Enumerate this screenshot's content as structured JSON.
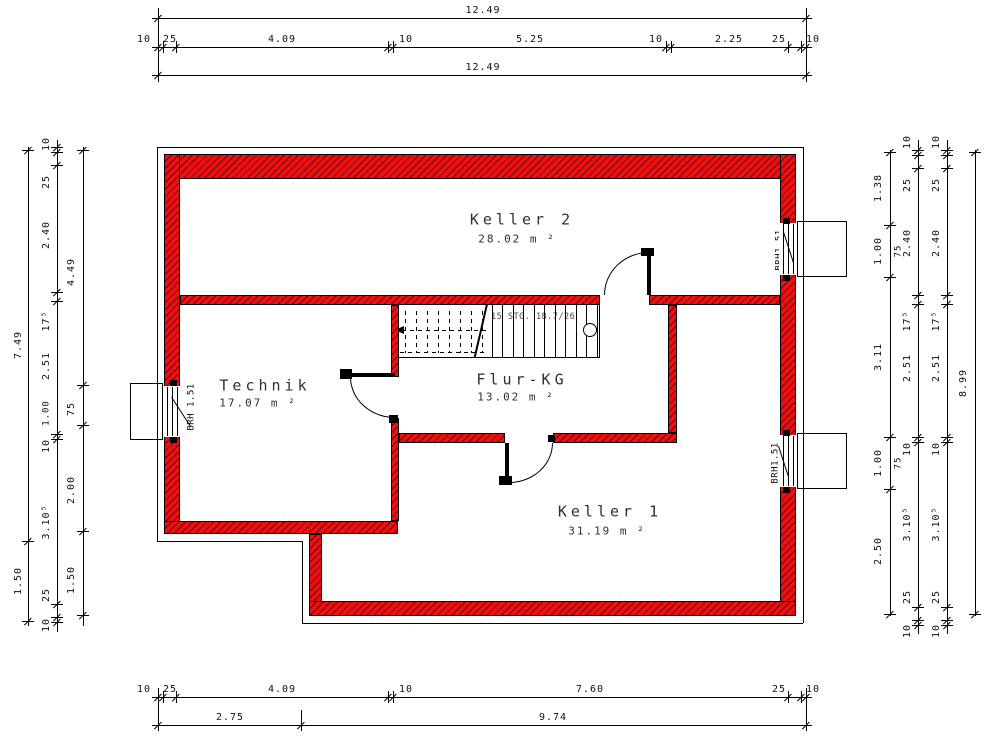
{
  "colors": {
    "wall": "#ee1010",
    "wall_hatch": "#3c0000",
    "line": "#000000",
    "dim_text": "#111111"
  },
  "rooms": [
    {
      "name": "Keller 2",
      "area": "28.02 m ²"
    },
    {
      "name": "Technik",
      "area": "17.07 m ²"
    },
    {
      "name": "Flur-KG",
      "area": "13.02 m ²"
    },
    {
      "name": "Keller 1",
      "area": "31.19 m ²"
    }
  ],
  "stair": {
    "note": "15 STG. 18.7/26"
  },
  "windows": [
    {
      "id": "left",
      "brh": "BRH 1.51",
      "tags": [
        "LS",
        "DK"
      ]
    },
    {
      "id": "right-top",
      "brh": "BRH1.51",
      "tags": [
        "DK",
        "LS"
      ]
    },
    {
      "id": "right-bottom",
      "brh": "BRH1.51",
      "tags": [
        "DK",
        "LS"
      ]
    }
  ],
  "dims": {
    "h": [
      {
        "y": 18,
        "x1": 152,
        "x2": 812,
        "ticks": [
          158,
          806
        ],
        "labels": [
          [
            "12.49",
            483
          ]
        ]
      },
      {
        "y": 47,
        "x1": 152,
        "x2": 812,
        "ticks": [
          158,
          163,
          176,
          388,
          393,
          666,
          671,
          788,
          801,
          806
        ],
        "labels": [
          [
            "10",
            144
          ],
          [
            "25",
            170
          ],
          [
            "4.09",
            282
          ],
          [
            "10",
            406
          ],
          [
            "5.25",
            530
          ],
          [
            "10",
            656
          ],
          [
            "2.25",
            729
          ],
          [
            "25",
            779
          ],
          [
            "10",
            813
          ]
        ]
      },
      {
        "y": 75,
        "x1": 152,
        "x2": 812,
        "ticks": [
          158,
          806
        ],
        "labels": [
          [
            "12.49",
            483
          ]
        ]
      },
      {
        "y": 697,
        "x1": 152,
        "x2": 812,
        "ticks": [
          158,
          163,
          176,
          388,
          393,
          788,
          801,
          806
        ],
        "labels": [
          [
            "10",
            144
          ],
          [
            "25",
            170
          ],
          [
            "4.09",
            282
          ],
          [
            "10",
            406
          ],
          [
            "7.60",
            590
          ],
          [
            "25",
            779
          ],
          [
            "10",
            813
          ]
        ]
      },
      {
        "y": 725,
        "x1": 152,
        "x2": 812,
        "ticks": [
          158,
          301,
          806
        ],
        "labels": [
          [
            "2.75",
            230
          ],
          [
            "9.74",
            553
          ]
        ]
      }
    ],
    "v": [
      {
        "x": 28,
        "lx": 19,
        "y1": 147,
        "y2": 626,
        "ticks": [
          150,
          541,
          621
        ],
        "labels": [
          [
            "7.49",
            345
          ],
          [
            "1.50",
            581
          ]
        ]
      },
      {
        "x": 57,
        "lx": 47,
        "y1": 140,
        "y2": 632,
        "ticks": [
          147,
          152,
          165,
          292,
          301,
          434,
          439,
          604,
          617,
          622
        ],
        "labels": [
          [
            "10",
            144
          ],
          [
            "25",
            182
          ],
          [
            "2.40",
            235
          ],
          [
            "17⁵",
            321
          ],
          [
            "2.51",
            366
          ],
          [
            "10",
            446
          ],
          [
            "3.10⁵",
            522
          ],
          [
            "25",
            595
          ],
          [
            "10",
            625
          ]
        ]
      },
      {
        "x": 83,
        "lx": 72,
        "y1": 147,
        "y2": 626,
        "ticks": [
          150,
          385,
          425,
          531,
          615
        ],
        "labels": [
          [
            "4.49",
            272
          ],
          [
            "75",
            409
          ],
          [
            "2.00",
            490
          ],
          [
            "1.50",
            580
          ]
        ]
      },
      {
        "x": 890,
        "lx": 879,
        "y1": 150,
        "y2": 616,
        "ticks": [
          152,
          225,
          277,
          437,
          489,
          614
        ],
        "labels": [
          [
            "1.38",
            188
          ],
          [
            "1.00",
            251
          ],
          [
            "3.11",
            357
          ],
          [
            "1.00",
            463
          ],
          [
            "2.50",
            551
          ]
        ]
      },
      {
        "x": 918,
        "lx": 908,
        "y1": 140,
        "y2": 634,
        "ticks": [
          150,
          155,
          168,
          295,
          304,
          437,
          442,
          607,
          620,
          625
        ],
        "labels": [
          [
            "10",
            142
          ],
          [
            "25",
            185
          ],
          [
            "2.40",
            243
          ],
          [
            "17⁵",
            321
          ],
          [
            "2.51",
            368
          ],
          [
            "10",
            449
          ],
          [
            "3.10⁵",
            524
          ],
          [
            "25",
            597
          ],
          [
            "10",
            631
          ]
        ]
      },
      {
        "x": 947,
        "lx": 937,
        "y1": 140,
        "y2": 634,
        "ticks": [
          150,
          155,
          168,
          295,
          304,
          437,
          442,
          607,
          620,
          625
        ],
        "labels": [
          [
            "10",
            142
          ],
          [
            "25",
            185
          ],
          [
            "2.40",
            243
          ],
          [
            "17⁵",
            321
          ],
          [
            "2.51",
            368
          ],
          [
            "10",
            449
          ],
          [
            "3.10⁵",
            524
          ],
          [
            "25",
            597
          ],
          [
            "10",
            631
          ]
        ]
      },
      {
        "x": 975,
        "lx": 964,
        "y1": 150,
        "y2": 616,
        "ticks": [
          152,
          614
        ],
        "labels": [
          [
            "8.99",
            383
          ]
        ]
      }
    ],
    "extras": [
      [
        "1.00",
        47,
        413
      ],
      [
        "75",
        899,
        251
      ],
      [
        "75",
        899,
        463
      ]
    ]
  },
  "geometry": {
    "walls": [
      {
        "x": 164,
        "y": 154,
        "w": 632,
        "h": 25
      },
      {
        "x": 164,
        "y": 154,
        "w": 16,
        "h": 380
      },
      {
        "x": 780,
        "y": 154,
        "w": 16,
        "h": 462
      },
      {
        "x": 164,
        "y": 521,
        "w": 234,
        "h": 13
      },
      {
        "x": 309,
        "y": 534,
        "w": 13,
        "h": 82
      },
      {
        "x": 309,
        "y": 601,
        "w": 487,
        "h": 15
      },
      {
        "x": 180,
        "y": 295,
        "w": 420,
        "h": 10
      },
      {
        "x": 649,
        "y": 295,
        "w": 131,
        "h": 10
      },
      {
        "x": 391,
        "y": 305,
        "w": 8,
        "h": 72
      },
      {
        "x": 391,
        "y": 418,
        "w": 8,
        "h": 103
      },
      {
        "x": 399,
        "y": 433,
        "w": 106,
        "h": 10
      },
      {
        "x": 553,
        "y": 433,
        "w": 124,
        "h": 10
      },
      {
        "x": 668,
        "y": 305,
        "w": 9,
        "h": 128
      }
    ],
    "white_rects": [
      {
        "x": 163,
        "y": 386,
        "w": 18,
        "h": 51
      },
      {
        "x": 779,
        "y": 223,
        "w": 18,
        "h": 52
      },
      {
        "x": 779,
        "y": 435,
        "w": 18,
        "h": 52
      },
      {
        "x": 130,
        "y": 383,
        "w": 33,
        "h": 57,
        "b": 1
      },
      {
        "x": 797,
        "y": 221,
        "w": 50,
        "h": 56,
        "b": 1
      },
      {
        "x": 797,
        "y": 433,
        "w": 50,
        "h": 56,
        "b": 1
      }
    ],
    "lines": [
      {
        "x": 157,
        "y": 147,
        "w": 646,
        "h": 1
      },
      {
        "x": 157,
        "y": 147,
        "w": 1,
        "h": 394
      },
      {
        "x": 803,
        "y": 147,
        "w": 1,
        "h": 476
      },
      {
        "x": 157,
        "y": 541,
        "w": 145,
        "h": 1
      },
      {
        "x": 302,
        "y": 541,
        "w": 1,
        "h": 82
      },
      {
        "x": 302,
        "y": 623,
        "w": 501,
        "h": 1
      },
      {
        "x": 167,
        "y": 387,
        "w": 1,
        "h": 49
      },
      {
        "x": 172,
        "y": 387,
        "w": 1,
        "h": 49
      },
      {
        "x": 177,
        "y": 387,
        "w": 1,
        "h": 49
      },
      {
        "x": 783,
        "y": 224,
        "w": 1,
        "h": 50
      },
      {
        "x": 788,
        "y": 224,
        "w": 1,
        "h": 50
      },
      {
        "x": 793,
        "y": 224,
        "w": 1,
        "h": 50
      },
      {
        "x": 783,
        "y": 436,
        "w": 1,
        "h": 50
      },
      {
        "x": 788,
        "y": 436,
        "w": 1,
        "h": 50
      },
      {
        "x": 793,
        "y": 436,
        "w": 1,
        "h": 50
      },
      {
        "x": 492,
        "y": 305,
        "w": 1,
        "h": 52
      },
      {
        "x": 502,
        "y": 305,
        "w": 1,
        "h": 52
      },
      {
        "x": 513,
        "y": 305,
        "w": 1,
        "h": 52
      },
      {
        "x": 523,
        "y": 305,
        "w": 1,
        "h": 52
      },
      {
        "x": 534,
        "y": 305,
        "w": 1,
        "h": 52
      },
      {
        "x": 544,
        "y": 305,
        "w": 1,
        "h": 52
      },
      {
        "x": 555,
        "y": 305,
        "w": 1,
        "h": 52
      },
      {
        "x": 565,
        "y": 305,
        "w": 1,
        "h": 52
      },
      {
        "x": 576,
        "y": 305,
        "w": 1,
        "h": 52
      },
      {
        "x": 586,
        "y": 305,
        "w": 1,
        "h": 52
      },
      {
        "x": 597,
        "y": 305,
        "w": 1,
        "h": 52
      },
      {
        "x": 599,
        "y": 305,
        "w": 1,
        "h": 52
      },
      {
        "x": 399,
        "y": 357,
        "w": 201,
        "h": 1
      },
      {
        "x": 405,
        "y": 311,
        "w": 1,
        "h": 42,
        "d": 1
      },
      {
        "x": 416,
        "y": 311,
        "w": 1,
        "h": 42,
        "d": 1
      },
      {
        "x": 427,
        "y": 311,
        "w": 1,
        "h": 42,
        "d": 1
      },
      {
        "x": 438,
        "y": 311,
        "w": 1,
        "h": 42,
        "d": 1
      },
      {
        "x": 449,
        "y": 311,
        "w": 1,
        "h": 42,
        "d": 1
      },
      {
        "x": 460,
        "y": 311,
        "w": 1,
        "h": 42,
        "d": 1
      },
      {
        "x": 471,
        "y": 311,
        "w": 1,
        "h": 42,
        "d": 1
      },
      {
        "x": 482,
        "y": 311,
        "w": 1,
        "h": 42,
        "d": 1
      },
      {
        "x": 400,
        "y": 352,
        "w": 86,
        "h": 1,
        "d": 1
      },
      {
        "x": 402,
        "y": 330,
        "w": 84,
        "h": 1,
        "d": 1
      },
      {
        "x": 158,
        "y": 8,
        "w": 1,
        "h": 74
      },
      {
        "x": 806,
        "y": 8,
        "w": 1,
        "h": 74
      },
      {
        "x": 158,
        "y": 688,
        "w": 1,
        "h": 43
      },
      {
        "x": 806,
        "y": 688,
        "w": 1,
        "h": 43
      },
      {
        "x": 301,
        "y": 710,
        "w": 1,
        "h": 21
      }
    ],
    "rot_lines": [
      {
        "x": 486,
        "y": 304,
        "w": 2,
        "h": 55,
        "a": 13
      },
      {
        "x": 172,
        "y": 397,
        "w": 35,
        "h": 1,
        "a": 57
      },
      {
        "x": 784,
        "y": 232,
        "w": 33,
        "h": 1,
        "a": 72
      },
      {
        "x": 779,
        "y": 446,
        "w": 33,
        "h": 1,
        "a": 72
      }
    ],
    "blocks": [
      {
        "x": 647,
        "y": 252,
        "w": 4,
        "h": 43
      },
      {
        "x": 345,
        "y": 373,
        "w": 50,
        "h": 4
      },
      {
        "x": 505,
        "y": 443,
        "w": 4,
        "h": 40
      },
      {
        "x": 641,
        "y": 248,
        "w": 13,
        "h": 8
      },
      {
        "x": 340,
        "y": 369,
        "w": 12,
        "h": 10
      },
      {
        "x": 389,
        "y": 415,
        "w": 9,
        "h": 8
      },
      {
        "x": 499,
        "y": 476,
        "w": 13,
        "h": 9
      },
      {
        "x": 548,
        "y": 435,
        "w": 7,
        "h": 7
      },
      {
        "x": 170,
        "y": 380,
        "w": 7,
        "h": 6
      },
      {
        "x": 170,
        "y": 437,
        "w": 7,
        "h": 6
      },
      {
        "x": 783,
        "y": 218,
        "w": 7,
        "h": 6
      },
      {
        "x": 783,
        "y": 275,
        "w": 7,
        "h": 6
      },
      {
        "x": 783,
        "y": 430,
        "w": 7,
        "h": 6
      },
      {
        "x": 783,
        "y": 487,
        "w": 7,
        "h": 6
      }
    ],
    "arcs": [
      {
        "x": 604,
        "y": 252,
        "w": 45,
        "h": 43,
        "c": "tl"
      },
      {
        "x": 350,
        "y": 377,
        "w": 45,
        "h": 41,
        "c": "bl"
      },
      {
        "x": 509,
        "y": 443,
        "w": 44,
        "h": 40,
        "c": "br"
      }
    ],
    "circles": [
      {
        "cx": 590,
        "cy": 330,
        "r": 7
      }
    ]
  }
}
